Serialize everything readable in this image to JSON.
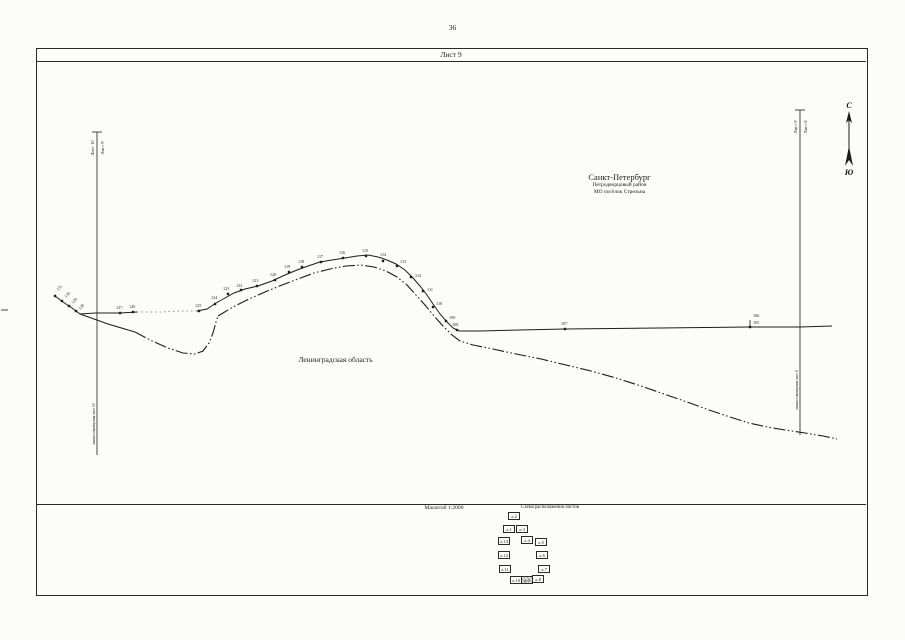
{
  "page": {
    "number": "36"
  },
  "sheet": {
    "title": "Лист 9"
  },
  "regions": {
    "spb": {
      "name": "Санкт-Петербург",
      "district": "Петродворцовый район",
      "municipality": "МО посёлок Стрельна"
    },
    "lenoblast": {
      "name": "Ленинградская область"
    }
  },
  "footer": {
    "scale": "Масштаб 1:2000",
    "scheme_title": "Схема расположения листов"
  },
  "compass": {
    "north": "С",
    "south": "Ю",
    "x": 849,
    "north_y": 108,
    "south_y": 175,
    "shaft": [
      849,
      118,
      849,
      158
    ],
    "head": "849,111 846,123 849,120 852,123",
    "fletch": "849,146 845,166 849,160 853,166"
  },
  "junctions": {
    "left": {
      "left_label": "Лист 10",
      "right_label": "Лист 9",
      "line_label": "линия совмещения лист 10",
      "geom": {
        "x": 97,
        "y1": 132,
        "y2": 455,
        "tick": [
          92,
          132,
          102,
          132
        ],
        "side_label_y": 148,
        "line_label_y": 424
      }
    },
    "right": {
      "left_label": "Лист 9",
      "right_label": "Лист 8",
      "line_label": "линия совмещения лист 8",
      "geom": {
        "x": 800,
        "y1": 110,
        "y2": 435,
        "tick": [
          795,
          110,
          805,
          110
        ],
        "side_label_y": 127,
        "line_label_y": 390
      }
    }
  },
  "scheme": {
    "sheets": [
      {
        "label": "л.2",
        "x": 13,
        "y": 8,
        "hl": false
      },
      {
        "label": "л.1",
        "x": 8,
        "y": 21,
        "hl": false
      },
      {
        "label": "л.3",
        "x": 21,
        "y": 21,
        "hl": false
      },
      {
        "label": "л.13",
        "x": 3,
        "y": 33,
        "hl": false
      },
      {
        "label": "л.4",
        "x": 26,
        "y": 32,
        "hl": false
      },
      {
        "label": "л.5",
        "x": 40,
        "y": 34,
        "hl": false
      },
      {
        "label": "л.12",
        "x": 3,
        "y": 47,
        "hl": false
      },
      {
        "label": "л.6",
        "x": 41,
        "y": 47,
        "hl": false
      },
      {
        "label": "л.11",
        "x": 4,
        "y": 61,
        "hl": false
      },
      {
        "label": "л.7",
        "x": 43,
        "y": 61,
        "hl": false
      },
      {
        "label": "л.10",
        "x": 15,
        "y": 72,
        "hl": false
      },
      {
        "label": "л.9",
        "x": 26,
        "y": 72,
        "hl": true
      },
      {
        "label": "л.8",
        "x": 37,
        "y": 71,
        "hl": false
      }
    ]
  },
  "map": {
    "solid_segments": [
      {
        "faint": false,
        "pts": [
          [
            55,
            296
          ],
          [
            63,
            302
          ],
          [
            72,
            308
          ],
          [
            80,
            314
          ],
          [
            95,
            313
          ],
          [
            120,
            313
          ],
          [
            137,
            312
          ]
        ]
      },
      {
        "faint": true,
        "pts": [
          [
            137,
            312
          ],
          [
            160,
            312
          ],
          [
            180,
            311
          ],
          [
            197,
            311
          ]
        ]
      },
      {
        "faint": false,
        "pts": [
          [
            197,
            311
          ],
          [
            207,
            309
          ],
          [
            216,
            303
          ],
          [
            225,
            298
          ],
          [
            234,
            293
          ],
          [
            245,
            289
          ],
          [
            258,
            286
          ],
          [
            272,
            281
          ],
          [
            285,
            275
          ],
          [
            297,
            270
          ],
          [
            308,
            266
          ],
          [
            320,
            262
          ],
          [
            332,
            260
          ],
          [
            345,
            258
          ],
          [
            357,
            256
          ],
          [
            368,
            255
          ],
          [
            378,
            257
          ],
          [
            387,
            260
          ],
          [
            396,
            264
          ],
          [
            405,
            270
          ],
          [
            413,
            278
          ],
          [
            420,
            286
          ],
          [
            427,
            295
          ],
          [
            433,
            304
          ],
          [
            440,
            314
          ],
          [
            447,
            322
          ],
          [
            453,
            328
          ],
          [
            459,
            331
          ]
        ]
      },
      {
        "faint": false,
        "pts": [
          [
            459,
            331
          ],
          [
            480,
            331
          ],
          [
            520,
            330
          ],
          [
            565,
            329
          ],
          [
            660,
            328
          ],
          [
            750,
            327
          ],
          [
            800,
            327
          ],
          [
            832,
            326
          ]
        ]
      },
      {
        "faint": false,
        "pts": [
          [
            80,
            314
          ],
          [
            108,
            324
          ],
          [
            135,
            332
          ]
        ]
      }
    ],
    "dash_segments": [
      {
        "pts": [
          [
            135,
            332
          ],
          [
            152,
            341
          ],
          [
            168,
            348
          ],
          [
            183,
            353
          ],
          [
            195,
            354
          ],
          [
            203,
            351
          ],
          [
            209,
            343
          ],
          [
            213,
            333
          ],
          [
            216,
            322
          ],
          [
            218,
            316
          ]
        ]
      },
      {
        "pts": [
          [
            218,
            316
          ],
          [
            233,
            307
          ],
          [
            249,
            299
          ],
          [
            265,
            292
          ],
          [
            282,
            285
          ],
          [
            298,
            279
          ],
          [
            314,
            273
          ],
          [
            330,
            269
          ],
          [
            346,
            266
          ],
          [
            361,
            265
          ],
          [
            374,
            267
          ],
          [
            386,
            271
          ],
          [
            397,
            277
          ],
          [
            407,
            285
          ],
          [
            416,
            295
          ],
          [
            425,
            305
          ],
          [
            434,
            316
          ],
          [
            443,
            326
          ],
          [
            452,
            335
          ],
          [
            460,
            341
          ],
          [
            473,
            345
          ],
          [
            493,
            349
          ],
          [
            516,
            354
          ],
          [
            541,
            359
          ],
          [
            566,
            365
          ],
          [
            591,
            371
          ],
          [
            616,
            378
          ],
          [
            641,
            386
          ],
          [
            664,
            394
          ],
          [
            687,
            402
          ],
          [
            709,
            410
          ],
          [
            730,
            417
          ],
          [
            749,
            423
          ],
          [
            767,
            427
          ],
          [
            785,
            430
          ],
          [
            805,
            433
          ],
          [
            823,
            436
          ],
          [
            837,
            439
          ]
        ]
      }
    ],
    "ticks": [
      [
        750,
        320,
        750,
        327
      ],
      [
        1,
        310,
        8,
        310
      ]
    ],
    "points": [
      {
        "n": "106",
        "m": [
          750,
          327
        ],
        "l": [
          753,
          317
        ]
      },
      {
        "n": "105",
        "l": [
          753,
          324
        ]
      },
      {
        "n": "107",
        "m": [
          565,
          329
        ],
        "l": [
          561,
          325
        ]
      },
      {
        "n": "108",
        "m": [
          457,
          330
        ],
        "l": [
          452,
          326
        ]
      },
      {
        "n": "109",
        "m": [
          446,
          321
        ],
        "l": [
          449,
          319
        ]
      },
      {
        "n": "110",
        "m": [
          433,
          307
        ],
        "l": [
          436,
          305
        ]
      },
      {
        "n": "111",
        "m": [
          423,
          291
        ],
        "l": [
          427,
          291
        ]
      },
      {
        "n": "112",
        "m": [
          411,
          277
        ],
        "l": [
          415,
          277
        ]
      },
      {
        "n": "113",
        "m": [
          397,
          266
        ],
        "l": [
          400,
          263
        ]
      },
      {
        "n": "114",
        "m": [
          383,
          261
        ],
        "l": [
          380,
          256
        ]
      },
      {
        "n": "115",
        "m": [
          366,
          256
        ],
        "l": [
          362,
          252
        ]
      },
      {
        "n": "116",
        "m": [
          343,
          258
        ],
        "l": [
          339,
          254
        ]
      },
      {
        "n": "117",
        "m": [
          321,
          262
        ],
        "l": [
          317,
          258
        ]
      },
      {
        "n": "118",
        "m": [
          302,
          267
        ],
        "l": [
          298,
          263
        ]
      },
      {
        "n": "119",
        "m": [
          289,
          272
        ],
        "l": [
          284,
          268
        ]
      },
      {
        "n": "120",
        "m": [
          275,
          280
        ],
        "l": [
          270,
          276
        ]
      },
      {
        "n": "121",
        "m": [
          257,
          286
        ],
        "l": [
          252,
          282
        ]
      },
      {
        "n": "122",
        "m": [
          241,
          290
        ],
        "l": [
          236,
          287
        ]
      },
      {
        "n": "123",
        "m": [
          228,
          294
        ],
        "l": [
          223,
          290
        ]
      },
      {
        "n": "124",
        "m": [
          215,
          304
        ],
        "l": [
          211,
          299
        ]
      },
      {
        "n": "125",
        "m": [
          199,
          311
        ],
        "l": [
          195,
          307
        ]
      },
      {
        "n": "126",
        "m": [
          133,
          312
        ],
        "l": [
          129,
          308
        ]
      },
      {
        "n": "127",
        "m": [
          120,
          313
        ],
        "l": [
          116,
          309
        ]
      },
      {
        "n": "128",
        "m": [
          76,
          311
        ],
        "l": [
          80,
          310
        ],
        "rot": -45
      },
      {
        "n": "129",
        "m": [
          69,
          306
        ],
        "l": [
          73,
          304
        ],
        "rot": -45
      },
      {
        "n": "130",
        "m": [
          62,
          301
        ],
        "l": [
          66,
          298
        ],
        "rot": -45
      },
      {
        "n": "131",
        "m": [
          55,
          296
        ],
        "l": [
          58,
          291
        ],
        "rot": -45
      }
    ]
  }
}
